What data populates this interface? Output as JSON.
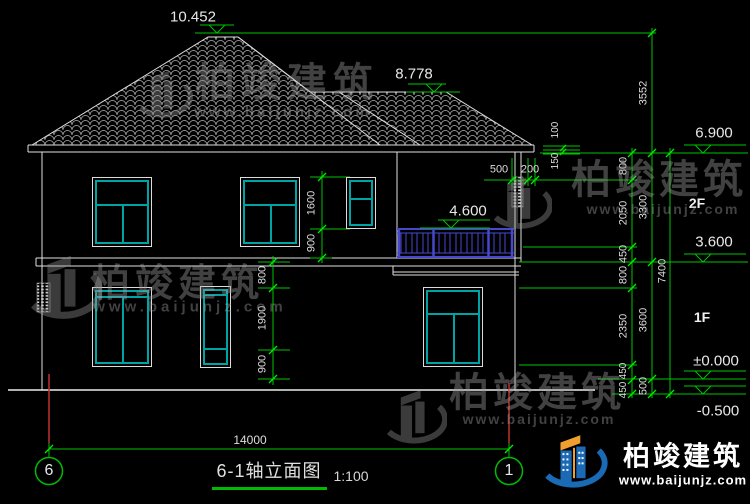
{
  "title_block": {
    "title": "6-1轴立面图",
    "scale": "1:100"
  },
  "axes": {
    "left": "6",
    "right": "1",
    "span": "14000"
  },
  "floors": {
    "f2": "2F",
    "f1": "1F"
  },
  "elevations": {
    "peak": "10.452",
    "ridge2": "8.778",
    "eave": "6.900",
    "balcony": "4.600",
    "floor2": "3.600",
    "zero": "±0.000",
    "site": "-0.500"
  },
  "dims": {
    "right_inner": [
      "800",
      "2050",
      "450",
      "800",
      "2350",
      "450",
      "450"
    ],
    "right_mid": [
      "3552",
      "3300",
      "3600",
      "500"
    ],
    "right_total": "7400",
    "eave_edge": [
      "100",
      "150"
    ],
    "eave_overhang": [
      "500",
      "200"
    ],
    "window_2f": [
      "1600",
      "900"
    ],
    "window_1f": [
      "800",
      "1900",
      "900"
    ]
  },
  "watermark": {
    "brand": "柏竣建筑",
    "url": "www.baijunjz.com"
  },
  "footer_logo": {
    "brand": "柏竣建筑",
    "url": "www.baijunjz.com"
  },
  "colors": {
    "background": "#000000",
    "cad_line": "#e0e0e0",
    "dim_line": "#00c400",
    "tick": "#00e800",
    "window_frame": "#00a3a3",
    "railing": "#4747cf",
    "axis_red": "#c23030",
    "underline_green": "#00bb00",
    "watermark_gray": "#9c9c9c",
    "logo_blue": "#1a6ab5",
    "logo_orange": "#f0a030"
  }
}
